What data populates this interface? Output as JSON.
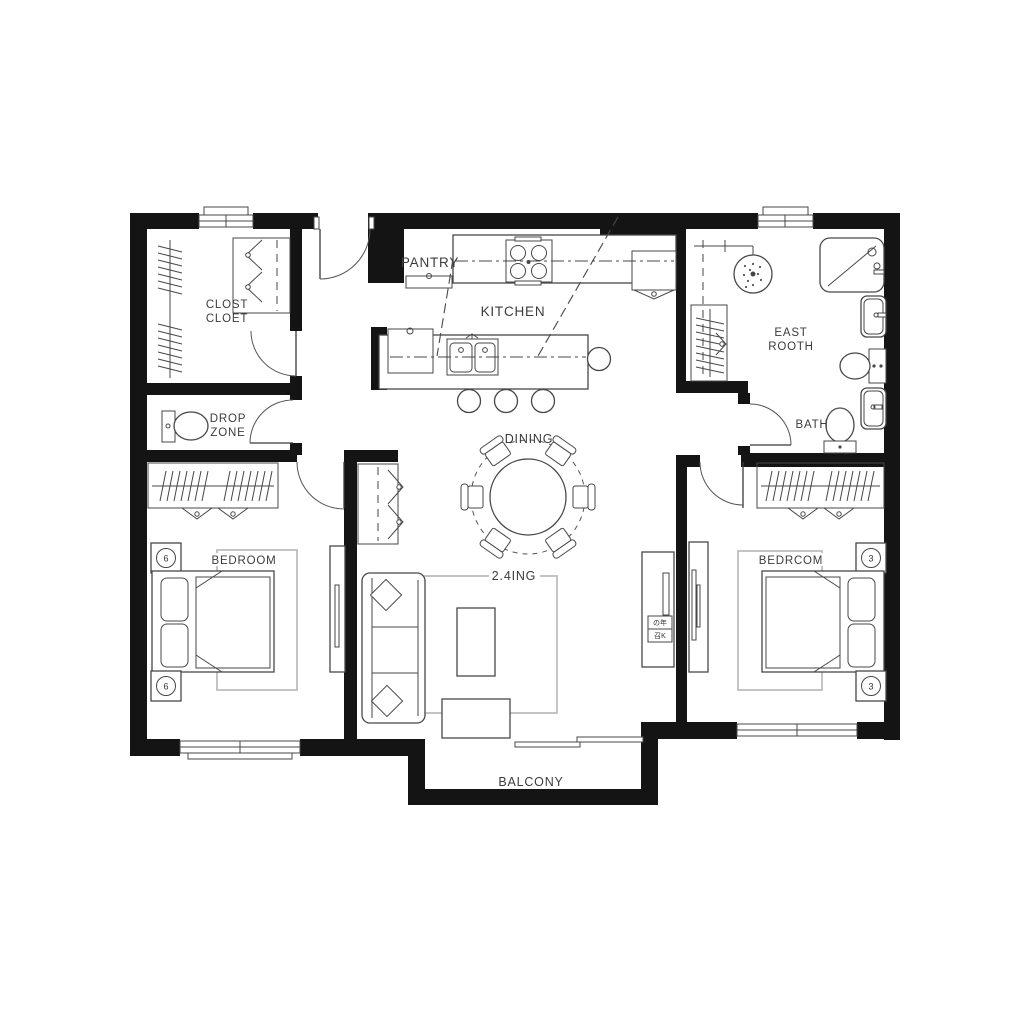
{
  "plan": {
    "rooms": {
      "closet": {
        "line1": "CLOST",
        "line2": "CLOET"
      },
      "drop_zone": {
        "line1": "DROP",
        "line2": "ZONE"
      },
      "pantry": {
        "label": "PANTRY"
      },
      "kitchen": {
        "label": "KITCHEN"
      },
      "east_rooth": {
        "line1": "EAST",
        "line2": "ROOTH"
      },
      "bath": {
        "label": "BATH"
      },
      "dining": {
        "label": "DINING"
      },
      "bedroom_left": {
        "label": "BEDROOM"
      },
      "living": {
        "label": "2.4ING"
      },
      "bedroom_right": {
        "label": "BEDRCOM"
      },
      "balcony": {
        "label": "BALCONY"
      }
    },
    "symbols": {
      "nightstand_left": "6",
      "nightstand_right": "3",
      "console_box_top": "の年",
      "console_box_bottom": "召K"
    },
    "colors": {
      "wall": "#141414",
      "line": "#474747",
      "rug": "#b5b5b5",
      "background": "#ffffff",
      "text": "#3c3c3c"
    }
  }
}
